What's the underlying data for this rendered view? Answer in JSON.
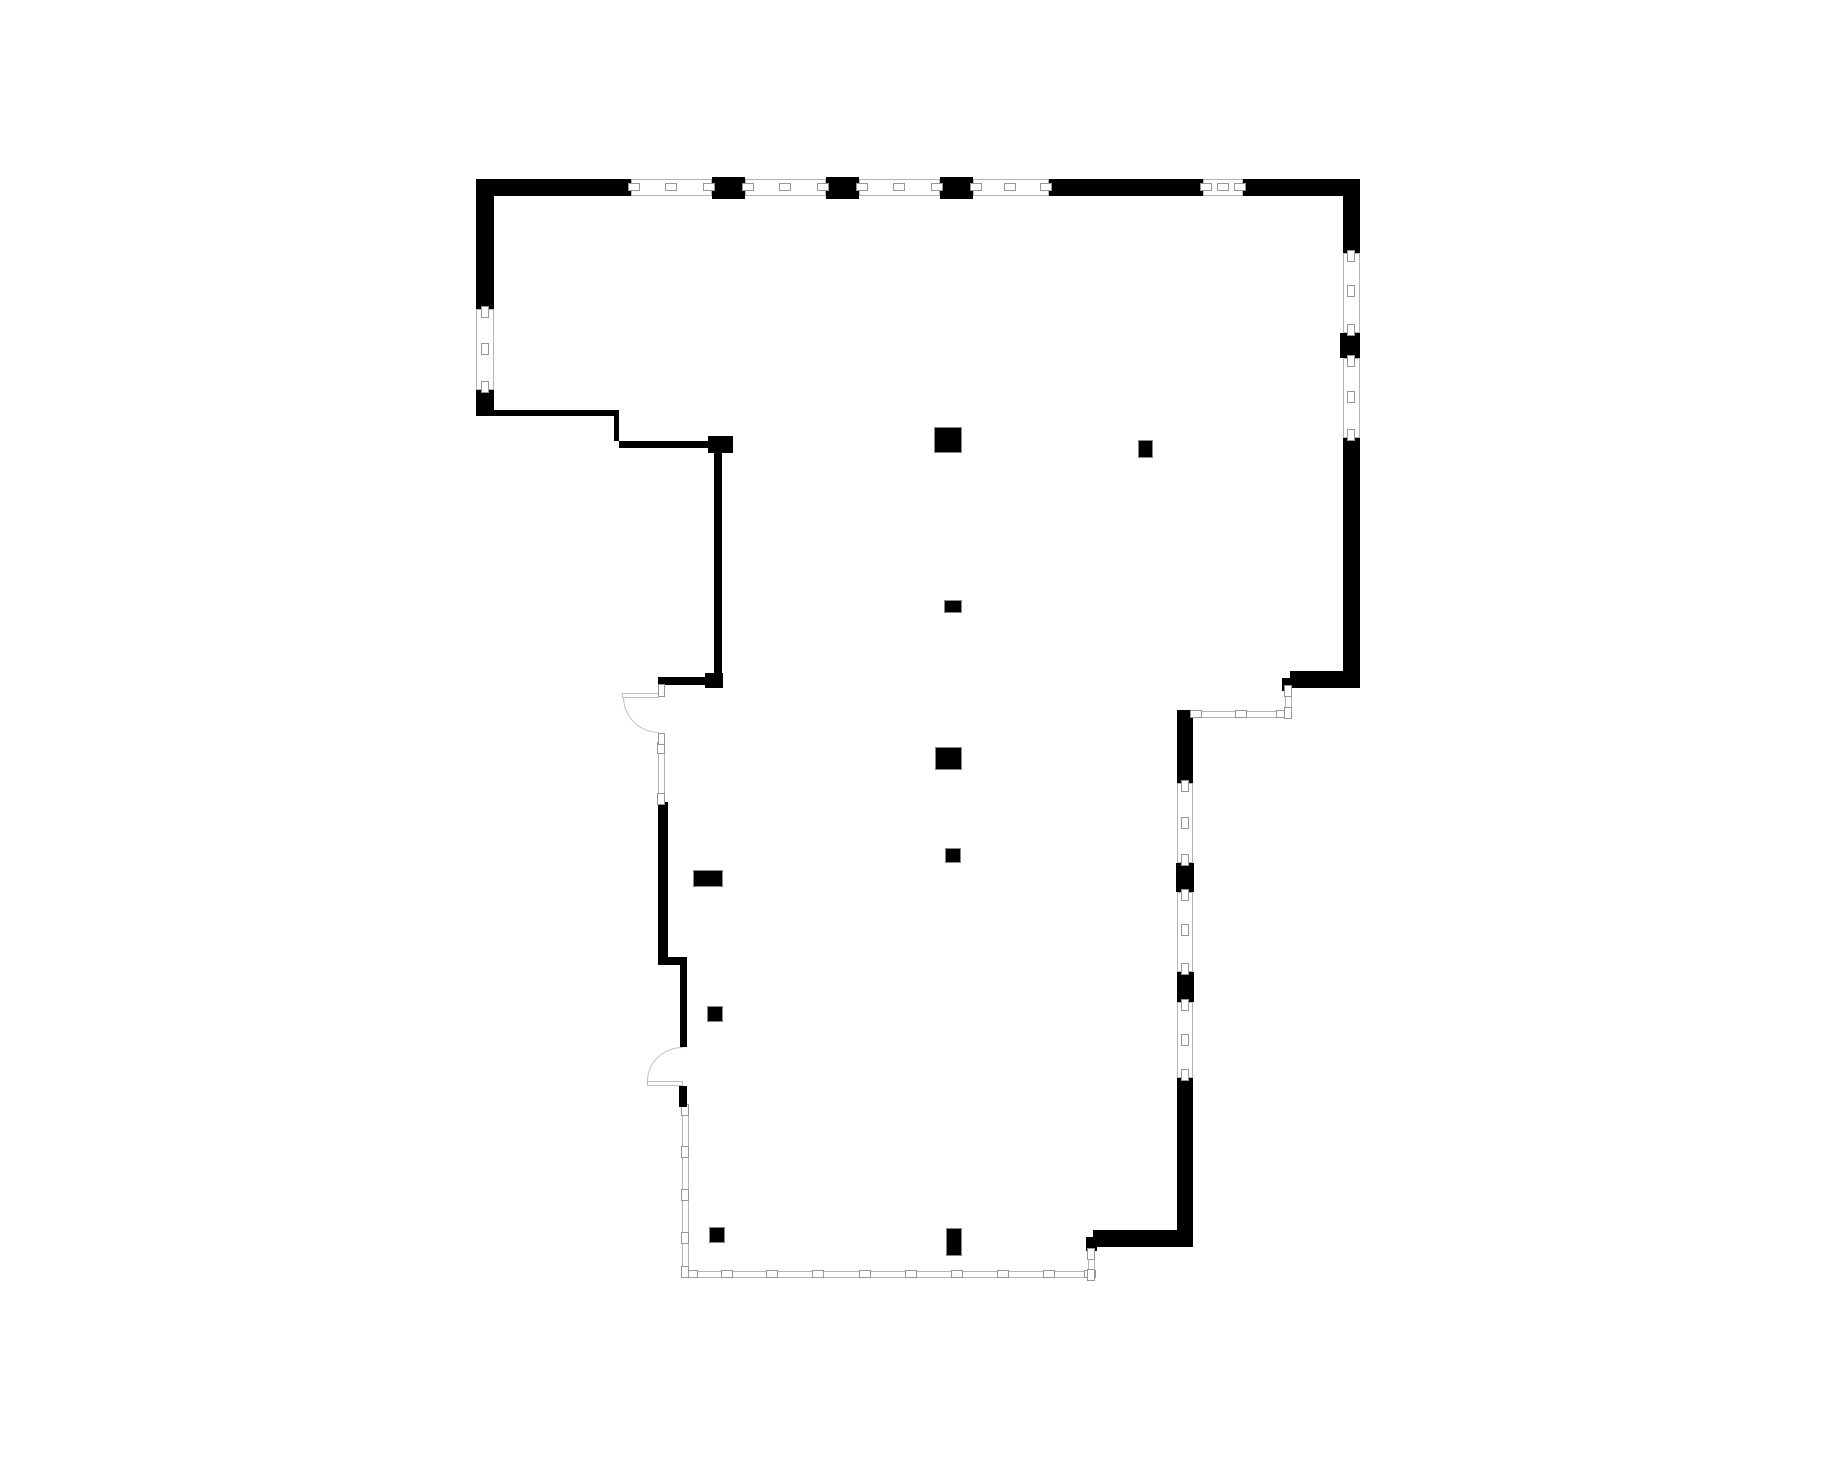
{
  "page": {
    "background": "#ffffff"
  },
  "floorplan": {
    "type": "architectural-floor-plan",
    "canvas": {
      "width": 1840,
      "height": 1460
    },
    "colors": {
      "paper": "#ffffff",
      "wall": "#000000",
      "window_line": "#b4b4b4",
      "tick_line": "#979797",
      "column_line": "#8a8a8a",
      "arc_line": "#bfbfbf"
    },
    "walls": [
      {
        "x": 476,
        "y": 179,
        "w": 155,
        "h": 17
      },
      {
        "x": 712,
        "y": 177,
        "w": 33,
        "h": 22
      },
      {
        "x": 826,
        "y": 177,
        "w": 33,
        "h": 22
      },
      {
        "x": 940,
        "y": 177,
        "w": 33,
        "h": 22
      },
      {
        "x": 1049,
        "y": 179,
        "w": 154,
        "h": 17
      },
      {
        "x": 1243,
        "y": 179,
        "w": 117,
        "h": 17
      },
      {
        "x": 476,
        "y": 179,
        "w": 18,
        "h": 130
      },
      {
        "x": 476,
        "y": 390,
        "w": 18,
        "h": 26
      },
      {
        "x": 1343,
        "y": 179,
        "w": 17,
        "h": 74
      },
      {
        "x": 1340,
        "y": 333,
        "w": 20,
        "h": 25
      },
      {
        "x": 1343,
        "y": 438,
        "w": 17,
        "h": 250
      },
      {
        "x": 1290,
        "y": 671,
        "w": 70,
        "h": 17
      },
      {
        "x": 1282,
        "y": 678,
        "w": 10,
        "h": 13
      },
      {
        "x": 494,
        "y": 410,
        "w": 125,
        "h": 6
      },
      {
        "x": 614,
        "y": 416,
        "w": 5,
        "h": 25
      },
      {
        "x": 619,
        "y": 441,
        "w": 89,
        "h": 7
      },
      {
        "x": 708,
        "y": 436,
        "w": 25,
        "h": 17
      },
      {
        "x": 714,
        "y": 453,
        "w": 8,
        "h": 224
      },
      {
        "x": 658,
        "y": 677,
        "w": 56,
        "h": 8
      },
      {
        "x": 705,
        "y": 673,
        "w": 18,
        "h": 15
      },
      {
        "x": 658,
        "y": 802,
        "w": 10,
        "h": 155
      },
      {
        "x": 658,
        "y": 957,
        "w": 29,
        "h": 8
      },
      {
        "x": 680,
        "y": 965,
        "w": 7,
        "h": 82
      },
      {
        "x": 1093,
        "y": 1230,
        "w": 100,
        "h": 17
      },
      {
        "x": 1177,
        "y": 1078,
        "w": 16,
        "h": 169
      },
      {
        "x": 1177,
        "y": 710,
        "w": 16,
        "h": 73
      },
      {
        "x": 1176,
        "y": 863,
        "w": 18,
        "h": 29
      },
      {
        "x": 1177,
        "y": 972,
        "w": 17,
        "h": 30
      },
      {
        "x": 1086,
        "y": 1237,
        "w": 11,
        "h": 14
      }
    ],
    "windows": [
      {
        "x": 631,
        "y": 179,
        "w": 81,
        "h": 17
      },
      {
        "x": 745,
        "y": 179,
        "w": 81,
        "h": 17
      },
      {
        "x": 859,
        "y": 179,
        "w": 81,
        "h": 17
      },
      {
        "x": 973,
        "y": 179,
        "w": 76,
        "h": 17
      },
      {
        "x": 1203,
        "y": 179,
        "w": 40,
        "h": 17
      },
      {
        "x": 476,
        "y": 309,
        "w": 18,
        "h": 81
      },
      {
        "x": 1343,
        "y": 253,
        "w": 17,
        "h": 80
      },
      {
        "x": 1343,
        "y": 358,
        "w": 17,
        "h": 80
      },
      {
        "x": 1193,
        "y": 711,
        "w": 92,
        "h": 7
      },
      {
        "x": 1285,
        "y": 688,
        "w": 7,
        "h": 28
      },
      {
        "x": 658,
        "y": 745,
        "w": 7,
        "h": 57
      },
      {
        "x": 682,
        "y": 1107,
        "w": 7,
        "h": 171
      },
      {
        "x": 689,
        "y": 1271,
        "w": 404,
        "h": 7
      },
      {
        "x": 1088,
        "y": 1251,
        "w": 7,
        "h": 27
      },
      {
        "x": 1177,
        "y": 783,
        "w": 16,
        "h": 80
      },
      {
        "x": 1177,
        "y": 892,
        "w": 16,
        "h": 80
      },
      {
        "x": 1177,
        "y": 1002,
        "w": 16,
        "h": 76
      }
    ],
    "mullions": [
      {
        "cx": 634,
        "cy": 187,
        "o": "h"
      },
      {
        "cx": 671,
        "cy": 187,
        "o": "h"
      },
      {
        "cx": 709,
        "cy": 187,
        "o": "h"
      },
      {
        "cx": 748,
        "cy": 187,
        "o": "h"
      },
      {
        "cx": 785,
        "cy": 187,
        "o": "h"
      },
      {
        "cx": 823,
        "cy": 187,
        "o": "h"
      },
      {
        "cx": 862,
        "cy": 187,
        "o": "h"
      },
      {
        "cx": 899,
        "cy": 187,
        "o": "h"
      },
      {
        "cx": 937,
        "cy": 187,
        "o": "h"
      },
      {
        "cx": 976,
        "cy": 187,
        "o": "h"
      },
      {
        "cx": 1010,
        "cy": 187,
        "o": "h"
      },
      {
        "cx": 1046,
        "cy": 187,
        "o": "h"
      },
      {
        "cx": 1206,
        "cy": 187,
        "o": "h"
      },
      {
        "cx": 1223,
        "cy": 187,
        "o": "h"
      },
      {
        "cx": 1240,
        "cy": 187,
        "o": "h"
      },
      {
        "cx": 1196,
        "cy": 714,
        "o": "h"
      },
      {
        "cx": 1241,
        "cy": 714,
        "o": "h"
      },
      {
        "cx": 1282,
        "cy": 714,
        "o": "h"
      },
      {
        "cx": 692,
        "cy": 1274,
        "o": "h"
      },
      {
        "cx": 727,
        "cy": 1274,
        "o": "h"
      },
      {
        "cx": 772,
        "cy": 1274,
        "o": "h"
      },
      {
        "cx": 818,
        "cy": 1274,
        "o": "h"
      },
      {
        "cx": 865,
        "cy": 1274,
        "o": "h"
      },
      {
        "cx": 911,
        "cy": 1274,
        "o": "h"
      },
      {
        "cx": 957,
        "cy": 1274,
        "o": "h"
      },
      {
        "cx": 1003,
        "cy": 1274,
        "o": "h"
      },
      {
        "cx": 1049,
        "cy": 1274,
        "o": "h"
      },
      {
        "cx": 1090,
        "cy": 1274,
        "o": "h"
      },
      {
        "cx": 485,
        "cy": 312,
        "o": "v"
      },
      {
        "cx": 485,
        "cy": 349,
        "o": "v"
      },
      {
        "cx": 485,
        "cy": 387,
        "o": "v"
      },
      {
        "cx": 1351,
        "cy": 256,
        "o": "v"
      },
      {
        "cx": 1351,
        "cy": 291,
        "o": "v"
      },
      {
        "cx": 1351,
        "cy": 330,
        "o": "v"
      },
      {
        "cx": 1351,
        "cy": 361,
        "o": "v"
      },
      {
        "cx": 1351,
        "cy": 397,
        "o": "v"
      },
      {
        "cx": 1351,
        "cy": 435,
        "o": "v"
      },
      {
        "cx": 1288,
        "cy": 691,
        "o": "v"
      },
      {
        "cx": 1288,
        "cy": 713,
        "o": "v"
      },
      {
        "cx": 661,
        "cy": 748,
        "o": "v"
      },
      {
        "cx": 661,
        "cy": 799,
        "o": "v"
      },
      {
        "cx": 685,
        "cy": 1110,
        "o": "v"
      },
      {
        "cx": 685,
        "cy": 1152,
        "o": "v"
      },
      {
        "cx": 685,
        "cy": 1195,
        "o": "v"
      },
      {
        "cx": 685,
        "cy": 1238,
        "o": "v"
      },
      {
        "cx": 685,
        "cy": 1272,
        "o": "v"
      },
      {
        "cx": 1091,
        "cy": 1254,
        "o": "v"
      },
      {
        "cx": 1091,
        "cy": 1275,
        "o": "v"
      },
      {
        "cx": 1185,
        "cy": 786,
        "o": "v"
      },
      {
        "cx": 1185,
        "cy": 823,
        "o": "v"
      },
      {
        "cx": 1185,
        "cy": 860,
        "o": "v"
      },
      {
        "cx": 1185,
        "cy": 895,
        "o": "v"
      },
      {
        "cx": 1185,
        "cy": 930,
        "o": "v"
      },
      {
        "cx": 1185,
        "cy": 969,
        "o": "v"
      },
      {
        "cx": 1185,
        "cy": 1005,
        "o": "v"
      },
      {
        "cx": 1185,
        "cy": 1040,
        "o": "v"
      },
      {
        "cx": 1185,
        "cy": 1075,
        "o": "v"
      }
    ],
    "columns": [
      {
        "x": 934,
        "y": 427,
        "w": 28,
        "h": 26
      },
      {
        "x": 944,
        "y": 600,
        "w": 18,
        "h": 13
      },
      {
        "x": 935,
        "y": 747,
        "w": 27,
        "h": 23
      },
      {
        "x": 945,
        "y": 848,
        "w": 16,
        "h": 15
      },
      {
        "x": 946,
        "y": 1228,
        "w": 16,
        "h": 28
      },
      {
        "x": 693,
        "y": 870,
        "w": 30,
        "h": 17
      },
      {
        "x": 707,
        "y": 1006,
        "w": 16,
        "h": 16
      },
      {
        "x": 709,
        "y": 1227,
        "w": 16,
        "h": 16
      },
      {
        "x": 1138,
        "y": 440,
        "w": 15,
        "h": 18
      }
    ],
    "doors": [
      {
        "leaf": {
          "x": 622,
          "y": 693,
          "w": 37,
          "h": 5
        },
        "arc": {
          "x": 623,
          "y": 697,
          "w": 36,
          "h": 36,
          "quadrant": "bl"
        },
        "jambs": [
          {
            "x": 658,
            "y": 684,
            "w": 7,
            "h": 13,
            "fill": "white"
          },
          {
            "x": 658,
            "y": 733,
            "w": 7,
            "h": 12,
            "fill": "white"
          }
        ]
      },
      {
        "leaf": {
          "x": 647,
          "y": 1081,
          "w": 36,
          "h": 5
        },
        "arc": {
          "x": 647,
          "y": 1047,
          "w": 36,
          "h": 34,
          "quadrant": "tl"
        },
        "jambs": [
          {
            "x": 679,
            "y": 1086,
            "w": 8,
            "h": 21,
            "fill": "black"
          }
        ]
      }
    ]
  }
}
